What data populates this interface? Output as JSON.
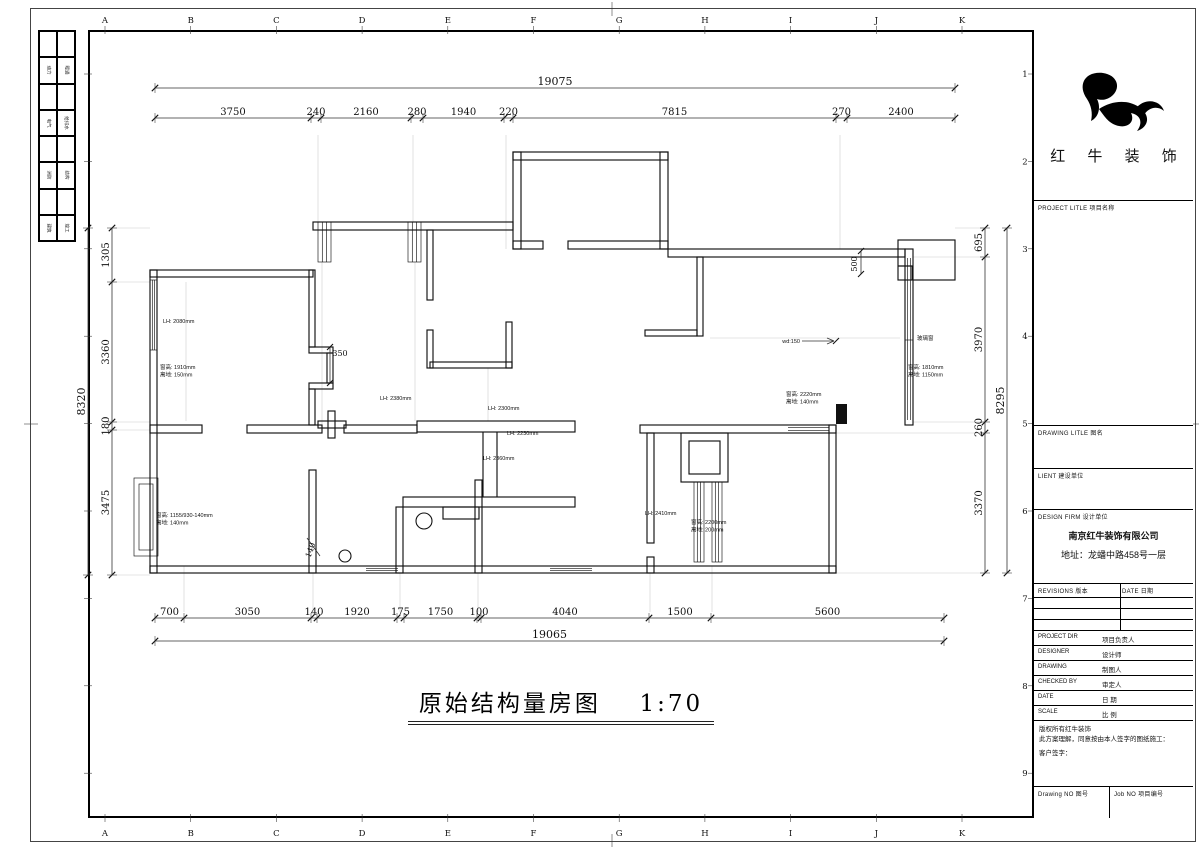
{
  "sheet": {
    "title": "原始结构量房图",
    "scale": "1:70",
    "grid_letters": [
      "A",
      "B",
      "C",
      "D",
      "E",
      "F",
      "G",
      "H",
      "I",
      "J",
      "K"
    ],
    "grid_numbers": [
      "1",
      "2",
      "3",
      "4",
      "5",
      "6",
      "7",
      "8",
      "9"
    ]
  },
  "logo": {
    "company": "红 牛 装 饰"
  },
  "title_block": {
    "project_label": "PROJECT LITLE  项目名称",
    "drawing_label": "DRAWING LITLE  图名",
    "client_label": "LIENT 建设单位",
    "design_firm_label": "DESIGN FIRM  设计单位",
    "firm_name": "南京红牛装饰有限公司",
    "firm_address": "地址：龙蟠中路458号一层",
    "revisions_label": "REVISIONS  版本",
    "revisions_date_label": "DATE  日期",
    "rows": [
      {
        "en": "PROJECT DIR",
        "zh": "项目负责人"
      },
      {
        "en": "DESIGNER",
        "zh": "设计师"
      },
      {
        "en": "DRAWING",
        "zh": "制图人"
      },
      {
        "en": "CHECKED BY",
        "zh": "审定人"
      },
      {
        "en": "DATE",
        "zh": "日  期"
      },
      {
        "en": "SCALE",
        "zh": "比  例"
      }
    ],
    "copyright_lines": [
      "版权所有红牛装饰",
      "此方案理解，同意按由本人签字的图纸施工：",
      "客户签字："
    ],
    "drawing_no_label": "Drawing NO  图号",
    "job_no_label": "Job NO  项目编号"
  },
  "side_strip": {
    "rows": [
      [
        "",
        ""
      ],
      [
        "动力",
        "暖通"
      ],
      [
        "",
        ""
      ],
      [
        "电气",
        "给排水"
      ],
      [
        "",
        ""
      ],
      [
        "消防",
        "结构"
      ],
      [
        "",
        ""
      ],
      [
        "建筑",
        "竣工"
      ]
    ]
  },
  "dimensions": {
    "top": {
      "total": "19075",
      "segments": [
        "3750",
        "240",
        "2160",
        "280",
        "1940",
        "220",
        "7815",
        "270",
        "2400"
      ],
      "tick_x": [
        155,
        311,
        321,
        411,
        423,
        504,
        513,
        836,
        847,
        955
      ],
      "total_y": 88,
      "seg_y": 118
    },
    "bottom": {
      "total": "19065",
      "segments": [
        "700",
        "3050",
        "140",
        "1920",
        "175",
        "1750",
        "100",
        "4040",
        "1500",
        "5600"
      ],
      "tick_x": [
        155,
        184,
        311,
        317,
        397,
        404,
        477,
        481,
        649,
        711,
        944
      ],
      "seg_y": 618,
      "total_y": 641
    },
    "left": {
      "total": "8320",
      "segments": [
        "1305",
        "3360",
        "180",
        "3475"
      ],
      "tick_y": [
        228,
        282,
        422,
        430,
        575
      ],
      "seg_x": 112,
      "total_x": 88
    },
    "right": {
      "total": "8295",
      "segments": [
        "695",
        "3970",
        "260",
        "3370"
      ],
      "tick_y": [
        228,
        257,
        422,
        433,
        573
      ],
      "seg_x": 985,
      "total_x": 1007
    }
  },
  "plan_labels": [
    {
      "x": 163,
      "y": 323,
      "lines": [
        "LH: 2080mm"
      ]
    },
    {
      "x": 160,
      "y": 369,
      "lines": [
        "窗高: 1910mm",
        "离地: 150mm"
      ]
    },
    {
      "x": 340,
      "y": 356,
      "lines": [
        "350"
      ],
      "cls": "small-dim",
      "anchor": "middle"
    },
    {
      "x": 380,
      "y": 400,
      "lines": [
        "LH: 2380mm"
      ]
    },
    {
      "x": 488,
      "y": 410,
      "lines": [
        "LH: 2300mm"
      ]
    },
    {
      "x": 507,
      "y": 435,
      "lines": [
        "LH: 2230mm"
      ]
    },
    {
      "x": 483,
      "y": 460,
      "lines": [
        "LH: 2360mm"
      ]
    },
    {
      "x": 786,
      "y": 396,
      "lines": [
        "窗高: 2220mm",
        "离地: 140mm"
      ]
    },
    {
      "x": 800,
      "y": 343,
      "lines": [
        "wd:150"
      ],
      "anchor": "end"
    },
    {
      "x": 917,
      "y": 340,
      "lines": [
        "玻璃窗"
      ]
    },
    {
      "x": 908,
      "y": 369,
      "lines": [
        "窗高: 1810mm",
        "离地: 1150mm"
      ]
    },
    {
      "x": 156,
      "y": 517,
      "lines": [
        "窗高: 1155/930-140mm",
        "离地: 140mm"
      ]
    },
    {
      "x": 313,
      "y": 551,
      "lines": [
        "140"
      ],
      "rot": -70,
      "cls": "small-dim",
      "anchor": "middle"
    },
    {
      "x": 857,
      "y": 264,
      "lines": [
        "500"
      ],
      "rot": -90,
      "cls": "small-dim",
      "anchor": "middle"
    },
    {
      "x": 645,
      "y": 515,
      "lines": [
        "LH: 2410mm"
      ]
    },
    {
      "x": 691,
      "y": 524,
      "lines": [
        "窗高: 2200mm",
        "离地: 200mm"
      ]
    }
  ]
}
